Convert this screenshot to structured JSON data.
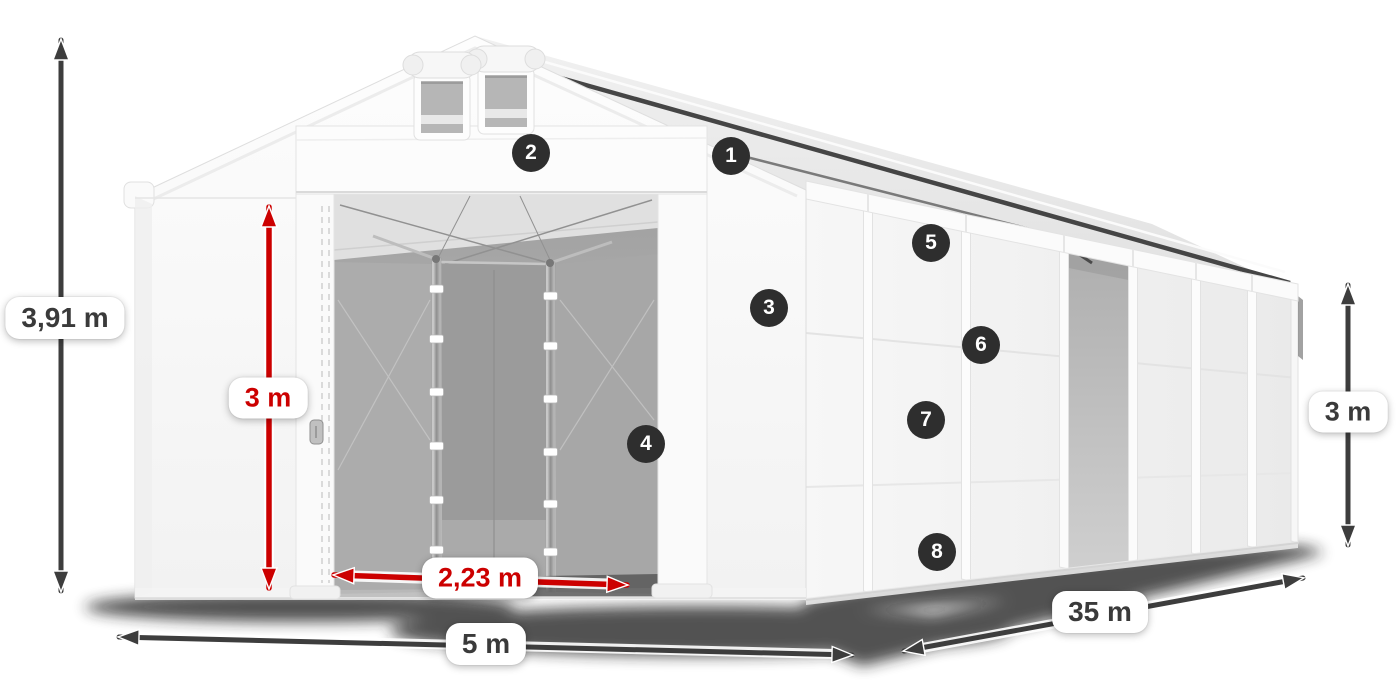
{
  "diagram": {
    "type": "tent-dimension-diagram",
    "background": "#ffffff"
  },
  "dimensions": {
    "total_height": {
      "label": "3,91 m",
      "color": "dark",
      "orientation": "vertical",
      "side": "left"
    },
    "inner_height": {
      "label": "3 m",
      "color": "red",
      "orientation": "vertical",
      "side": "front-door"
    },
    "door_width": {
      "label": "2,23 m",
      "color": "red",
      "orientation": "horizontal",
      "side": "front-door"
    },
    "width": {
      "label": "5 m",
      "color": "dark",
      "orientation": "horizontal",
      "side": "front"
    },
    "length": {
      "label": "35 m",
      "color": "dark",
      "orientation": "diagonal",
      "side": "right"
    },
    "side_height": {
      "label": "3 m",
      "color": "dark",
      "orientation": "vertical",
      "side": "right"
    }
  },
  "badges": [
    {
      "label": "1"
    },
    {
      "label": "2"
    },
    {
      "label": "3"
    },
    {
      "label": "4"
    },
    {
      "label": "5"
    },
    {
      "label": "6"
    },
    {
      "label": "7"
    },
    {
      "label": "8"
    }
  ],
  "colors": {
    "dark_arrow": "#3d3d3d",
    "red_arrow": "#cc0000",
    "badge_bg": "#2e2e2e",
    "badge_text": "#ffffff",
    "pill_bg": "#ffffff",
    "pill_text_dark": "#3a3a3a",
    "pill_text_red": "#cc0000"
  }
}
